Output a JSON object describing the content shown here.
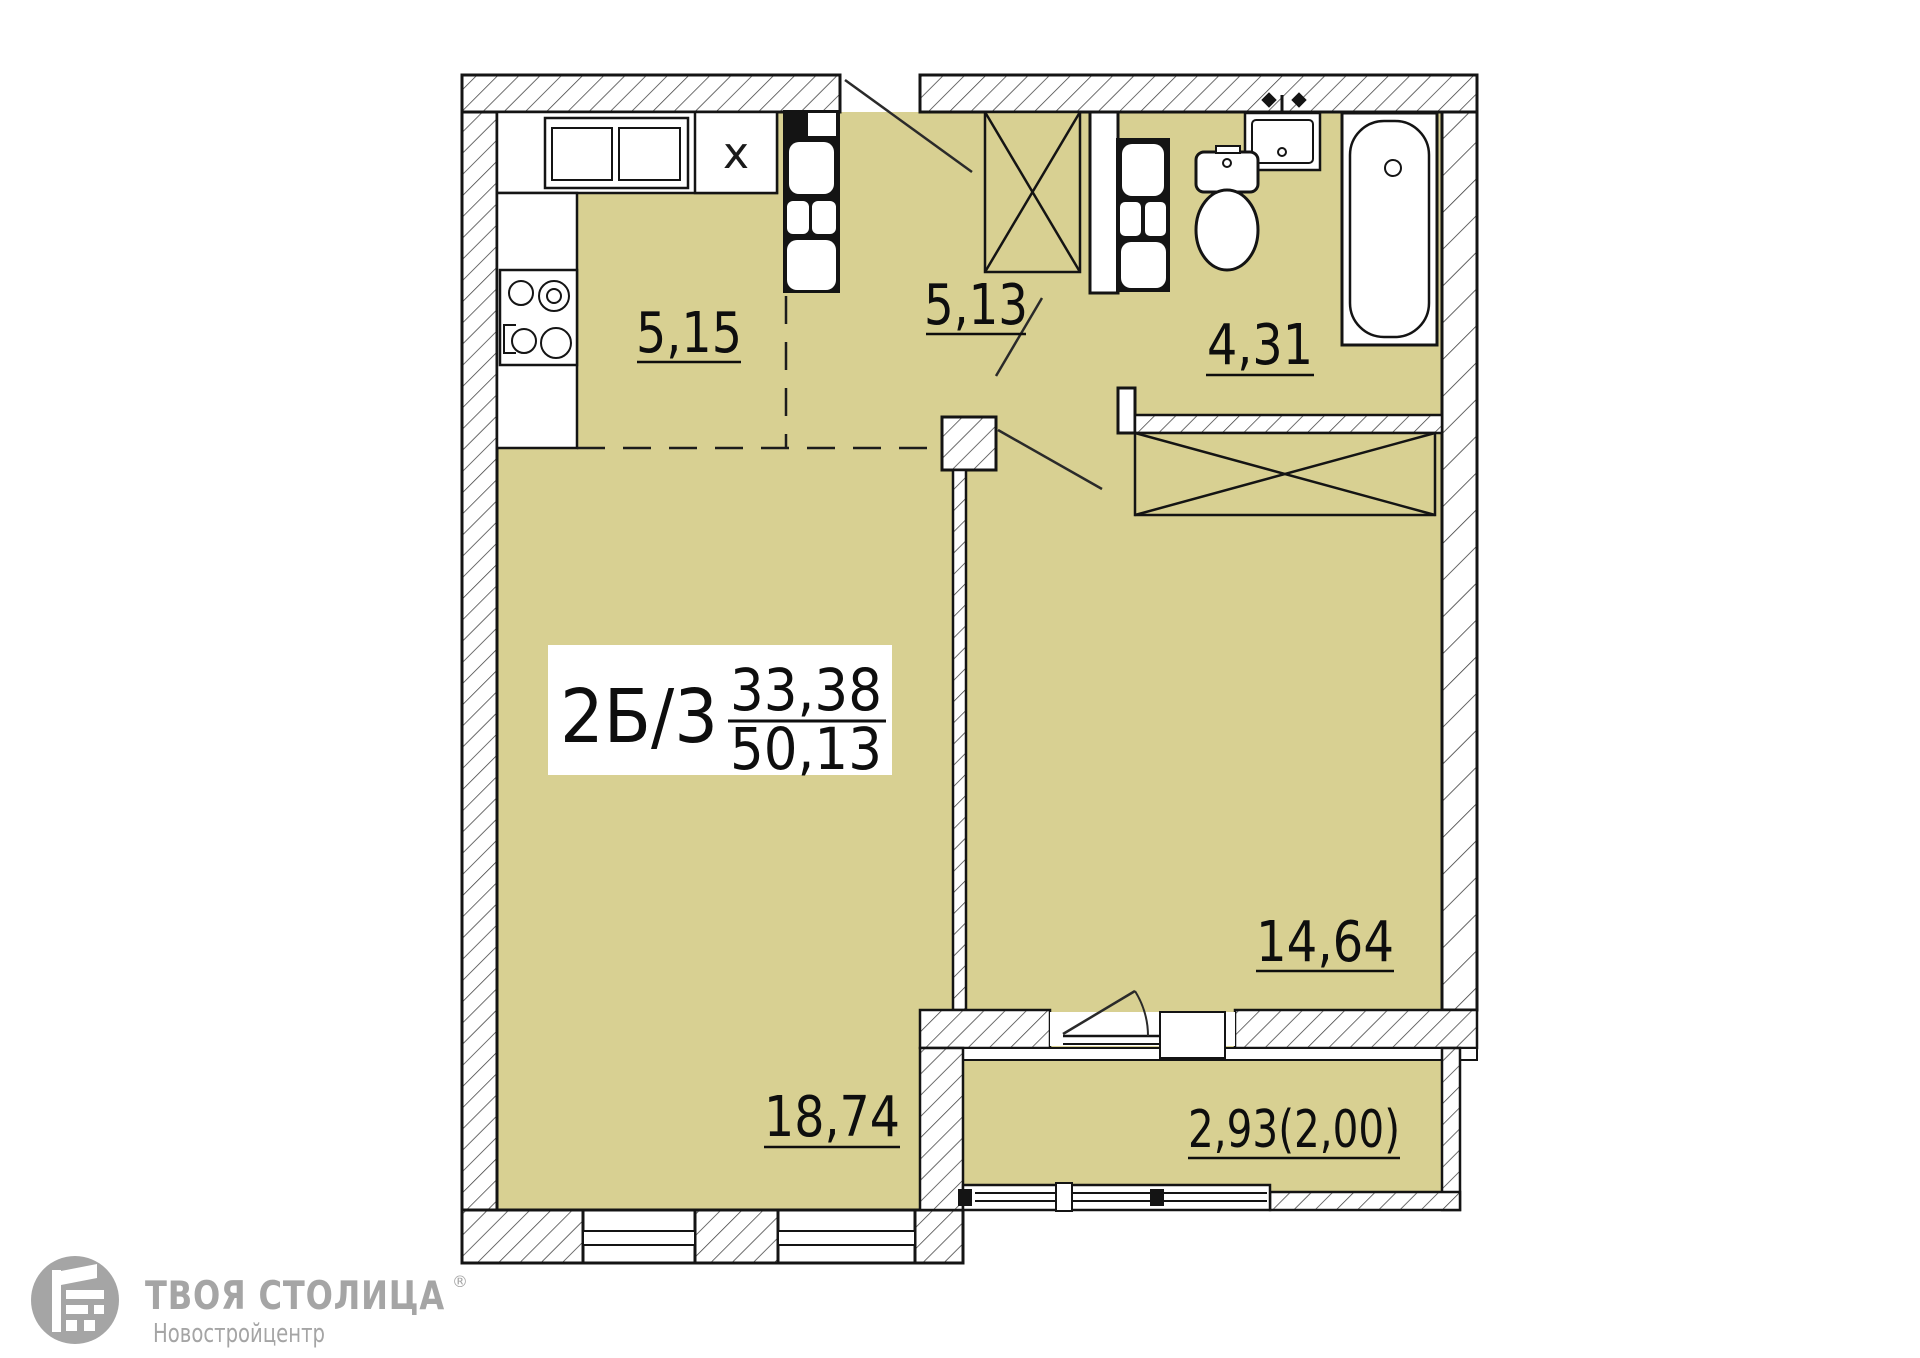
{
  "plan": {
    "unit": {
      "label": "2Б/3",
      "upper_area": "33,38",
      "lower_area": "50,13"
    },
    "rooms": {
      "kitchen": {
        "name": "kitchen",
        "area": "5,15"
      },
      "hallway": {
        "name": "hallway",
        "area": "5,13"
      },
      "bathroom": {
        "name": "bathroom",
        "area": "4,31"
      },
      "bedroom": {
        "name": "bedroom",
        "area": "14,64"
      },
      "living_room": {
        "name": "living-room",
        "area": "18,74"
      },
      "balcony": {
        "name": "balcony",
        "area": "2,93(2,00)"
      }
    },
    "marks": {
      "kitchen_cabinet": "x"
    },
    "colors": {
      "room_fill": "#d8d092",
      "wall_line": "#141414",
      "logo_gray": "#a5a5a5"
    }
  },
  "logo": {
    "brand": "ТВОЯ СТОЛИЦА",
    "registered": "®",
    "subtitle": "Новостройцентр"
  }
}
